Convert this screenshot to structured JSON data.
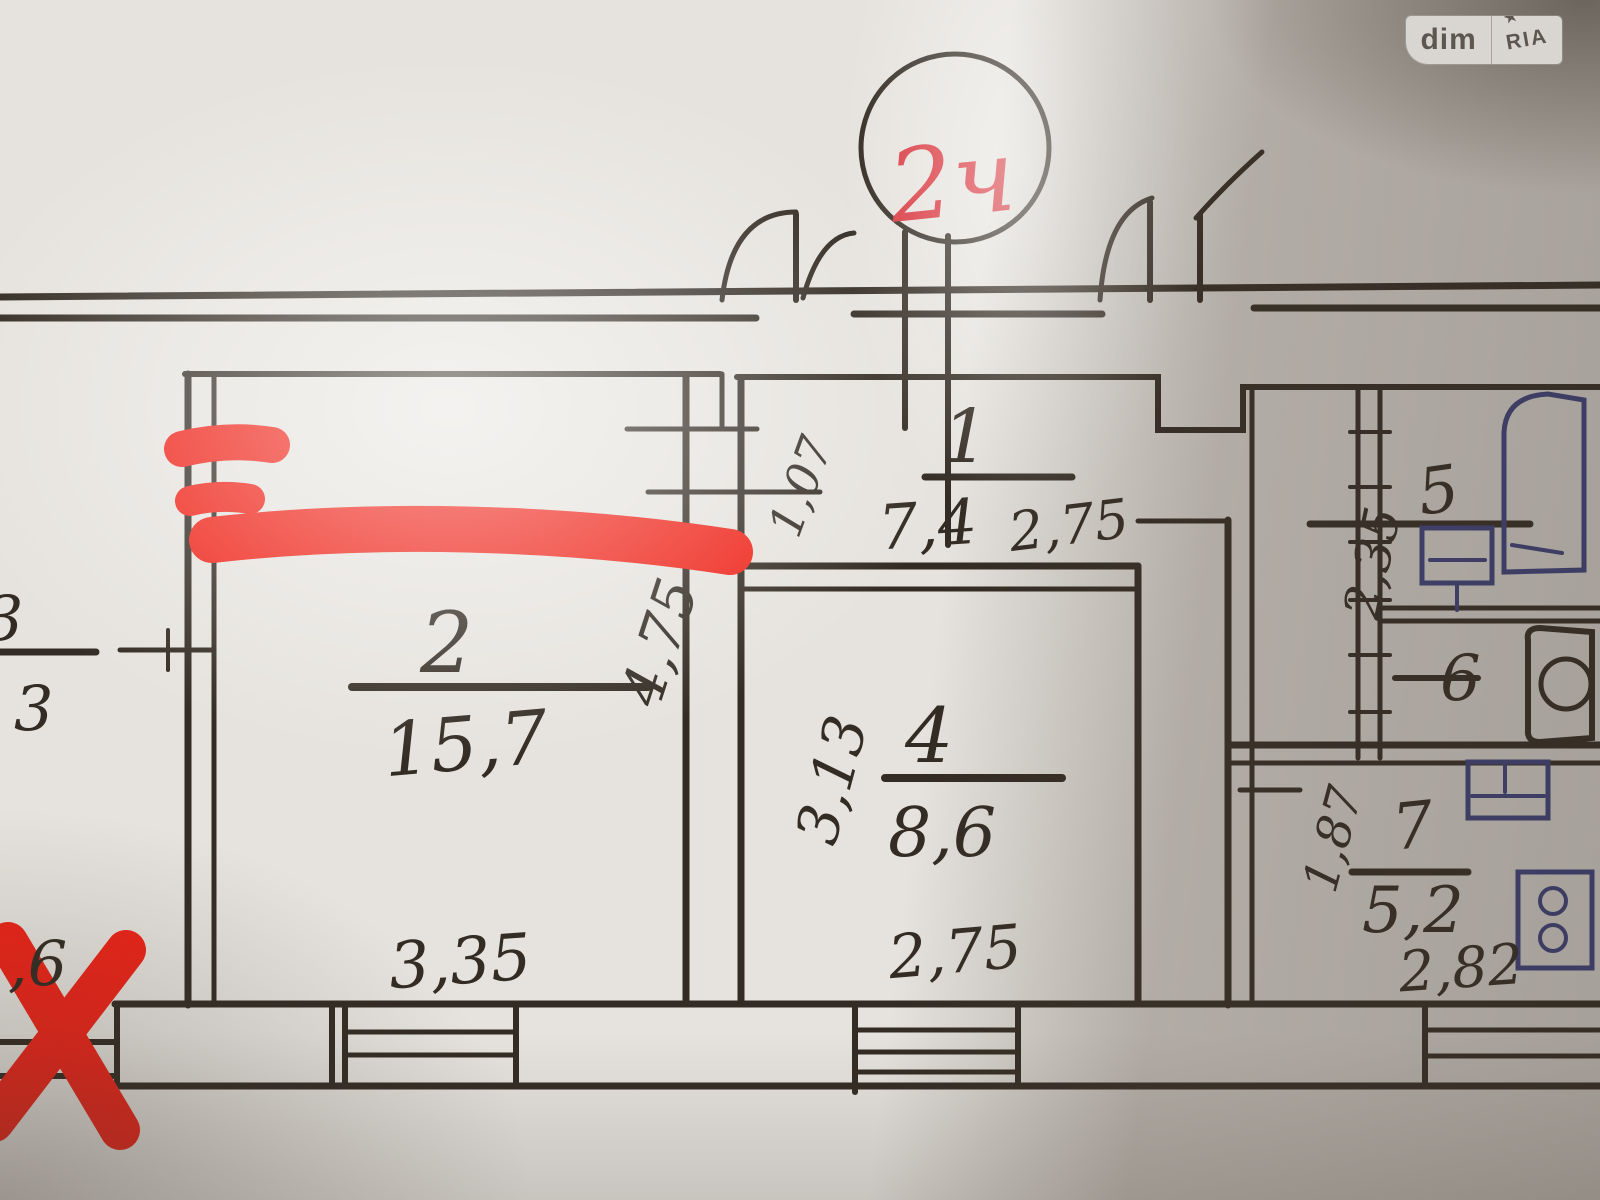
{
  "watermark": {
    "left": "dim",
    "right": "RIA",
    "star": "★"
  },
  "plan": {
    "circle_label": "2ч",
    "rooms": {
      "room1": {
        "number": "1",
        "area": "7,4",
        "width": "2,75"
      },
      "room2": {
        "number": "2",
        "area": "15,7",
        "width": "3,35",
        "depth": "4,75"
      },
      "room3": {
        "number": "3",
        "area_partial": "3"
      },
      "room4": {
        "number": "4",
        "area": "8,6",
        "width": "2,75",
        "depth": "3,13"
      },
      "room5": {
        "number": "5",
        "depth": "2,35"
      },
      "room6": {
        "number": "6"
      },
      "room7": {
        "number": "7",
        "area": "5,2",
        "width": "2,82",
        "depth": "1,87"
      }
    },
    "dims": {
      "hall_width": "1,07",
      "left_bottom_partial": ",6"
    }
  },
  "colors": {
    "ink": "#332c24",
    "red": "#ee2318",
    "blue": "#3d4285"
  }
}
